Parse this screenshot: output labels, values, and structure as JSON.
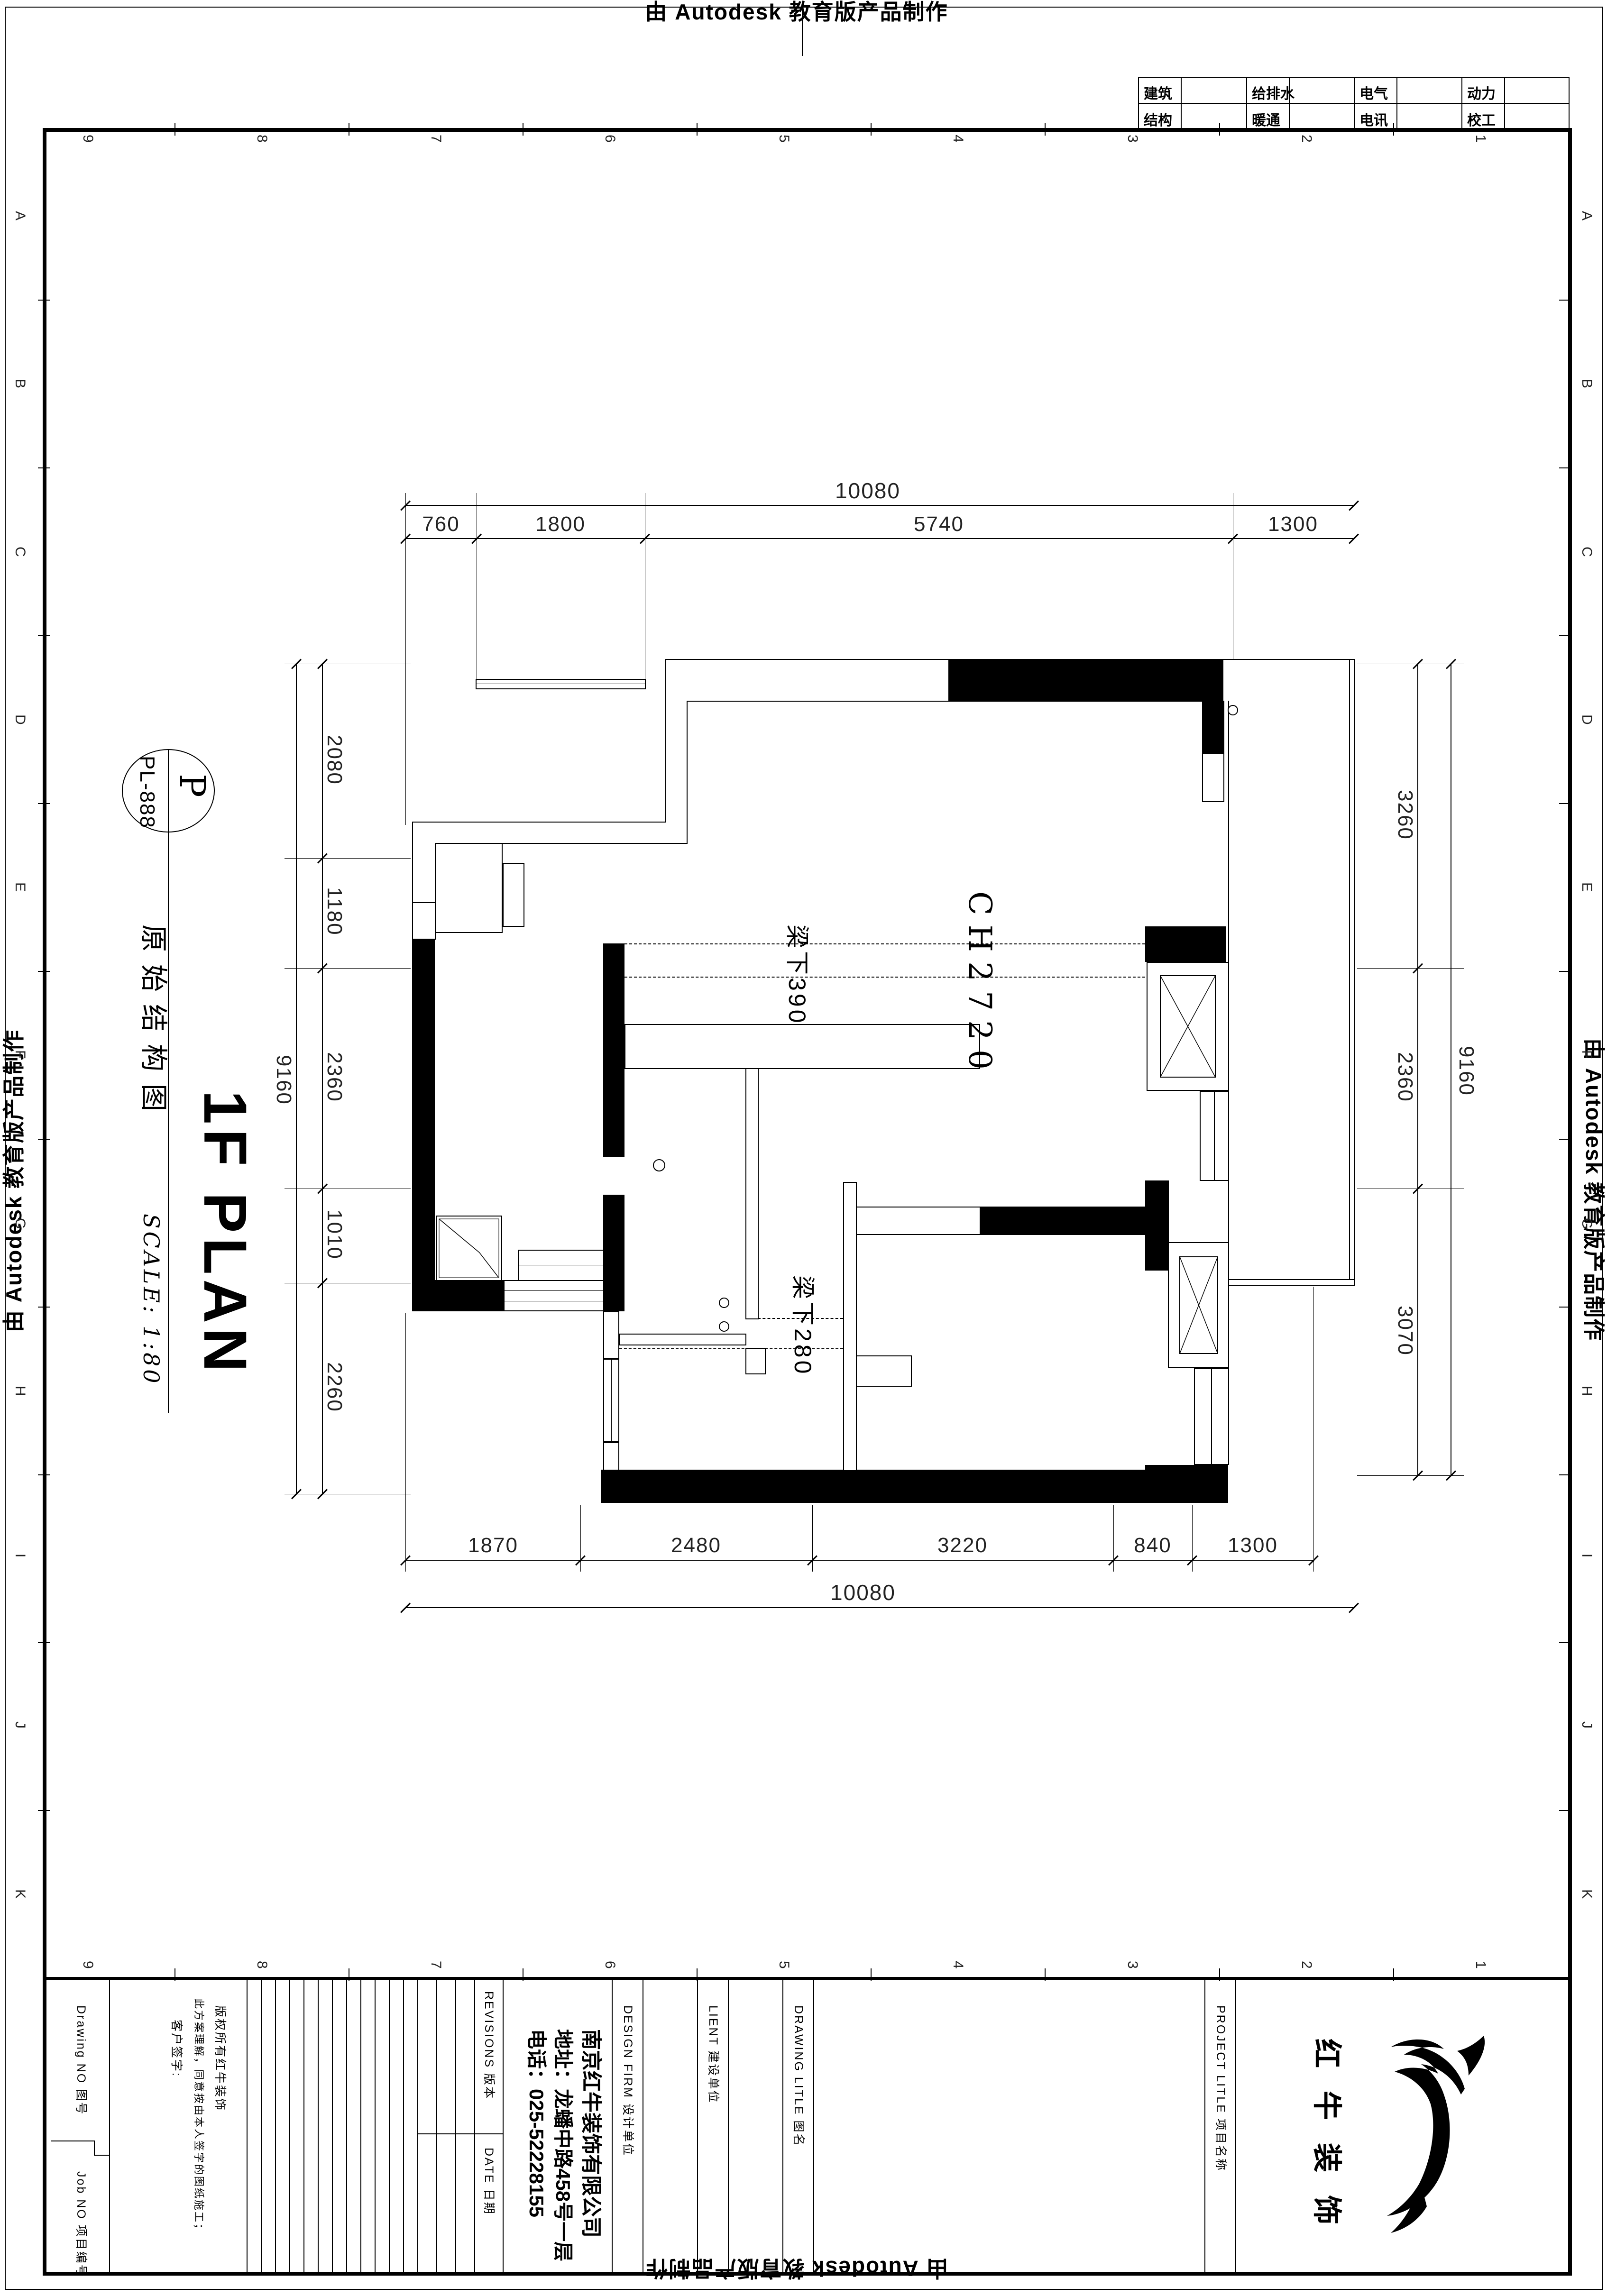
{
  "stamp": {
    "text": "由 Autodesk 教育版产品制作"
  },
  "disciplines": {
    "r1": [
      "建筑",
      "给排水",
      "电气",
      "动力"
    ],
    "r2": [
      "结构",
      "暖通",
      "电讯",
      "校工"
    ]
  },
  "grid": {
    "top_numbers": [
      "9",
      "8",
      "7",
      "6",
      "5",
      "4",
      "3",
      "2",
      "1"
    ],
    "bottom_numbers": [
      "9",
      "8",
      "7",
      "6",
      "5",
      "4",
      "3",
      "2",
      "1"
    ],
    "left_letters": [
      "A",
      "B",
      "C",
      "D",
      "E",
      "F",
      "G",
      "H",
      "I",
      "J",
      "K"
    ],
    "right_letters": [
      "A",
      "B",
      "C",
      "D",
      "E",
      "F",
      "G",
      "H",
      "I",
      "J",
      "K"
    ]
  },
  "titlebox": {
    "code": "PL-888",
    "code_letter": "P",
    "cn_title": "原始结构图",
    "en_title": "1F PLAN",
    "scale": "SCALE: 1:80"
  },
  "plan": {
    "room_label": "CH2720",
    "beam1": "梁下390",
    "beam2": "梁下280"
  },
  "dims": {
    "top": {
      "overall": "10080",
      "segments": [
        "760",
        "1800",
        "5740",
        "1300"
      ]
    },
    "bottom": {
      "overall": "10080",
      "segments": [
        "1870",
        "2480",
        "3220",
        "840",
        "1300"
      ]
    },
    "left": {
      "overall": "9160",
      "segments": [
        "2080",
        "1180",
        "2360",
        "1010",
        "2260"
      ]
    },
    "right": {
      "overall": "9160",
      "segments": [
        "3260",
        "2360",
        "3070"
      ]
    }
  },
  "titleblock": {
    "drawing_no": "Drawing NO  图号",
    "job_no": "Job NO  项目编号",
    "copyright_l1": "版权所有红牛装饰",
    "copyright_l2": "此方案理解，同意按由本人签字的图纸施工；",
    "copyright_l3": "客户签字:",
    "fields": [
      "SCALE    比 例",
      "DATE    日 期",
      "CHECKED BY   审定人",
      "DRAWING   制图人",
      "DESIGNER   设计师",
      "PROJECT DIR  项目负责人"
    ],
    "revisions": "REVISIONS  版本",
    "rev_date": "DATE  日期",
    "firm_name": "南京红牛装饰有限公司",
    "firm_addr": "地址：龙蟠中路458号一层",
    "firm_tel": "电话：025-52228155",
    "design_firm": "DESIGN FIRM  设计单位",
    "client": "LIENT  建设单位",
    "drawing_title": "DRAWING LITLE  图名",
    "project_title": "PROJECT LITLE  项目名称",
    "logo_text": "红牛装饰"
  }
}
